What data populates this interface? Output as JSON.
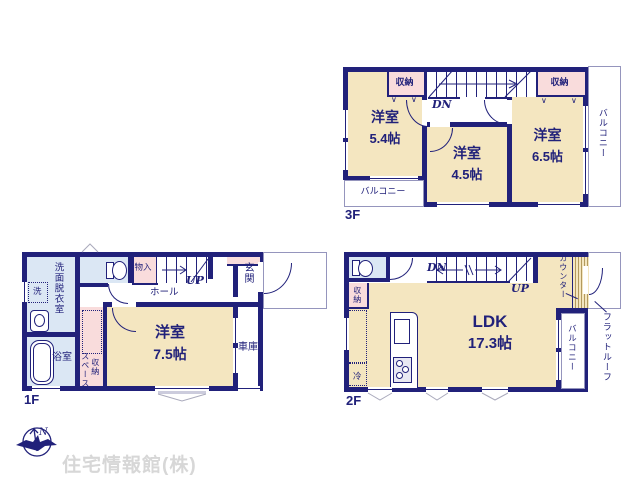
{
  "watermark": "住宅情報館(株)",
  "compass": {
    "north": "N"
  },
  "icons": {
    "closet_marker": "∨"
  },
  "colors": {
    "wall": "#21217a",
    "room": "#f4e6c0",
    "closet": "#f9dcdc",
    "wet_area": "#dbe7f4",
    "outline": "#9595bd",
    "counter_hatch": "#b39a5e",
    "watermark": "#d7d7d7"
  },
  "floor3": {
    "label": "3F",
    "room_54": {
      "name": "洋室",
      "area": "5.4帖"
    },
    "room_45": {
      "name": "洋室",
      "area": "4.5帖"
    },
    "room_65": {
      "name": "洋室",
      "area": "6.5帖"
    },
    "closet_left": {
      "label": "収納"
    },
    "closet_right": {
      "label": "収納"
    },
    "stairs": {
      "down": "DN"
    },
    "balcony_bottom": {
      "label": "バルコニー"
    },
    "balcony_right": {
      "label": "バルコニー"
    }
  },
  "floor1": {
    "label": "1F",
    "washroom": {
      "label": "洗面脱衣室"
    },
    "washer": {
      "label": "洗"
    },
    "bathroom": {
      "label": "浴室"
    },
    "closet": {
      "label": "物入"
    },
    "hall": {
      "label": "ホール"
    },
    "stairs": {
      "up": "UP"
    },
    "entrance": {
      "label": "玄関"
    },
    "bedroom": {
      "name": "洋室",
      "area": "7.5帖"
    },
    "storage": {
      "col_right": "収納",
      "col_left": "スペース"
    },
    "garage": {
      "label": "車庫"
    }
  },
  "floor2": {
    "label": "2F",
    "stairs": {
      "down": "DN",
      "up": "UP"
    },
    "closet": {
      "label": "収納"
    },
    "refrigerator": {
      "label": "冷"
    },
    "ldk": {
      "name": "LDK",
      "area": "17.3帖"
    },
    "counter": {
      "label": "カウンター"
    },
    "balcony": {
      "label": "バルコニー"
    },
    "flat_roof": {
      "label": "フラットルーフ"
    }
  }
}
